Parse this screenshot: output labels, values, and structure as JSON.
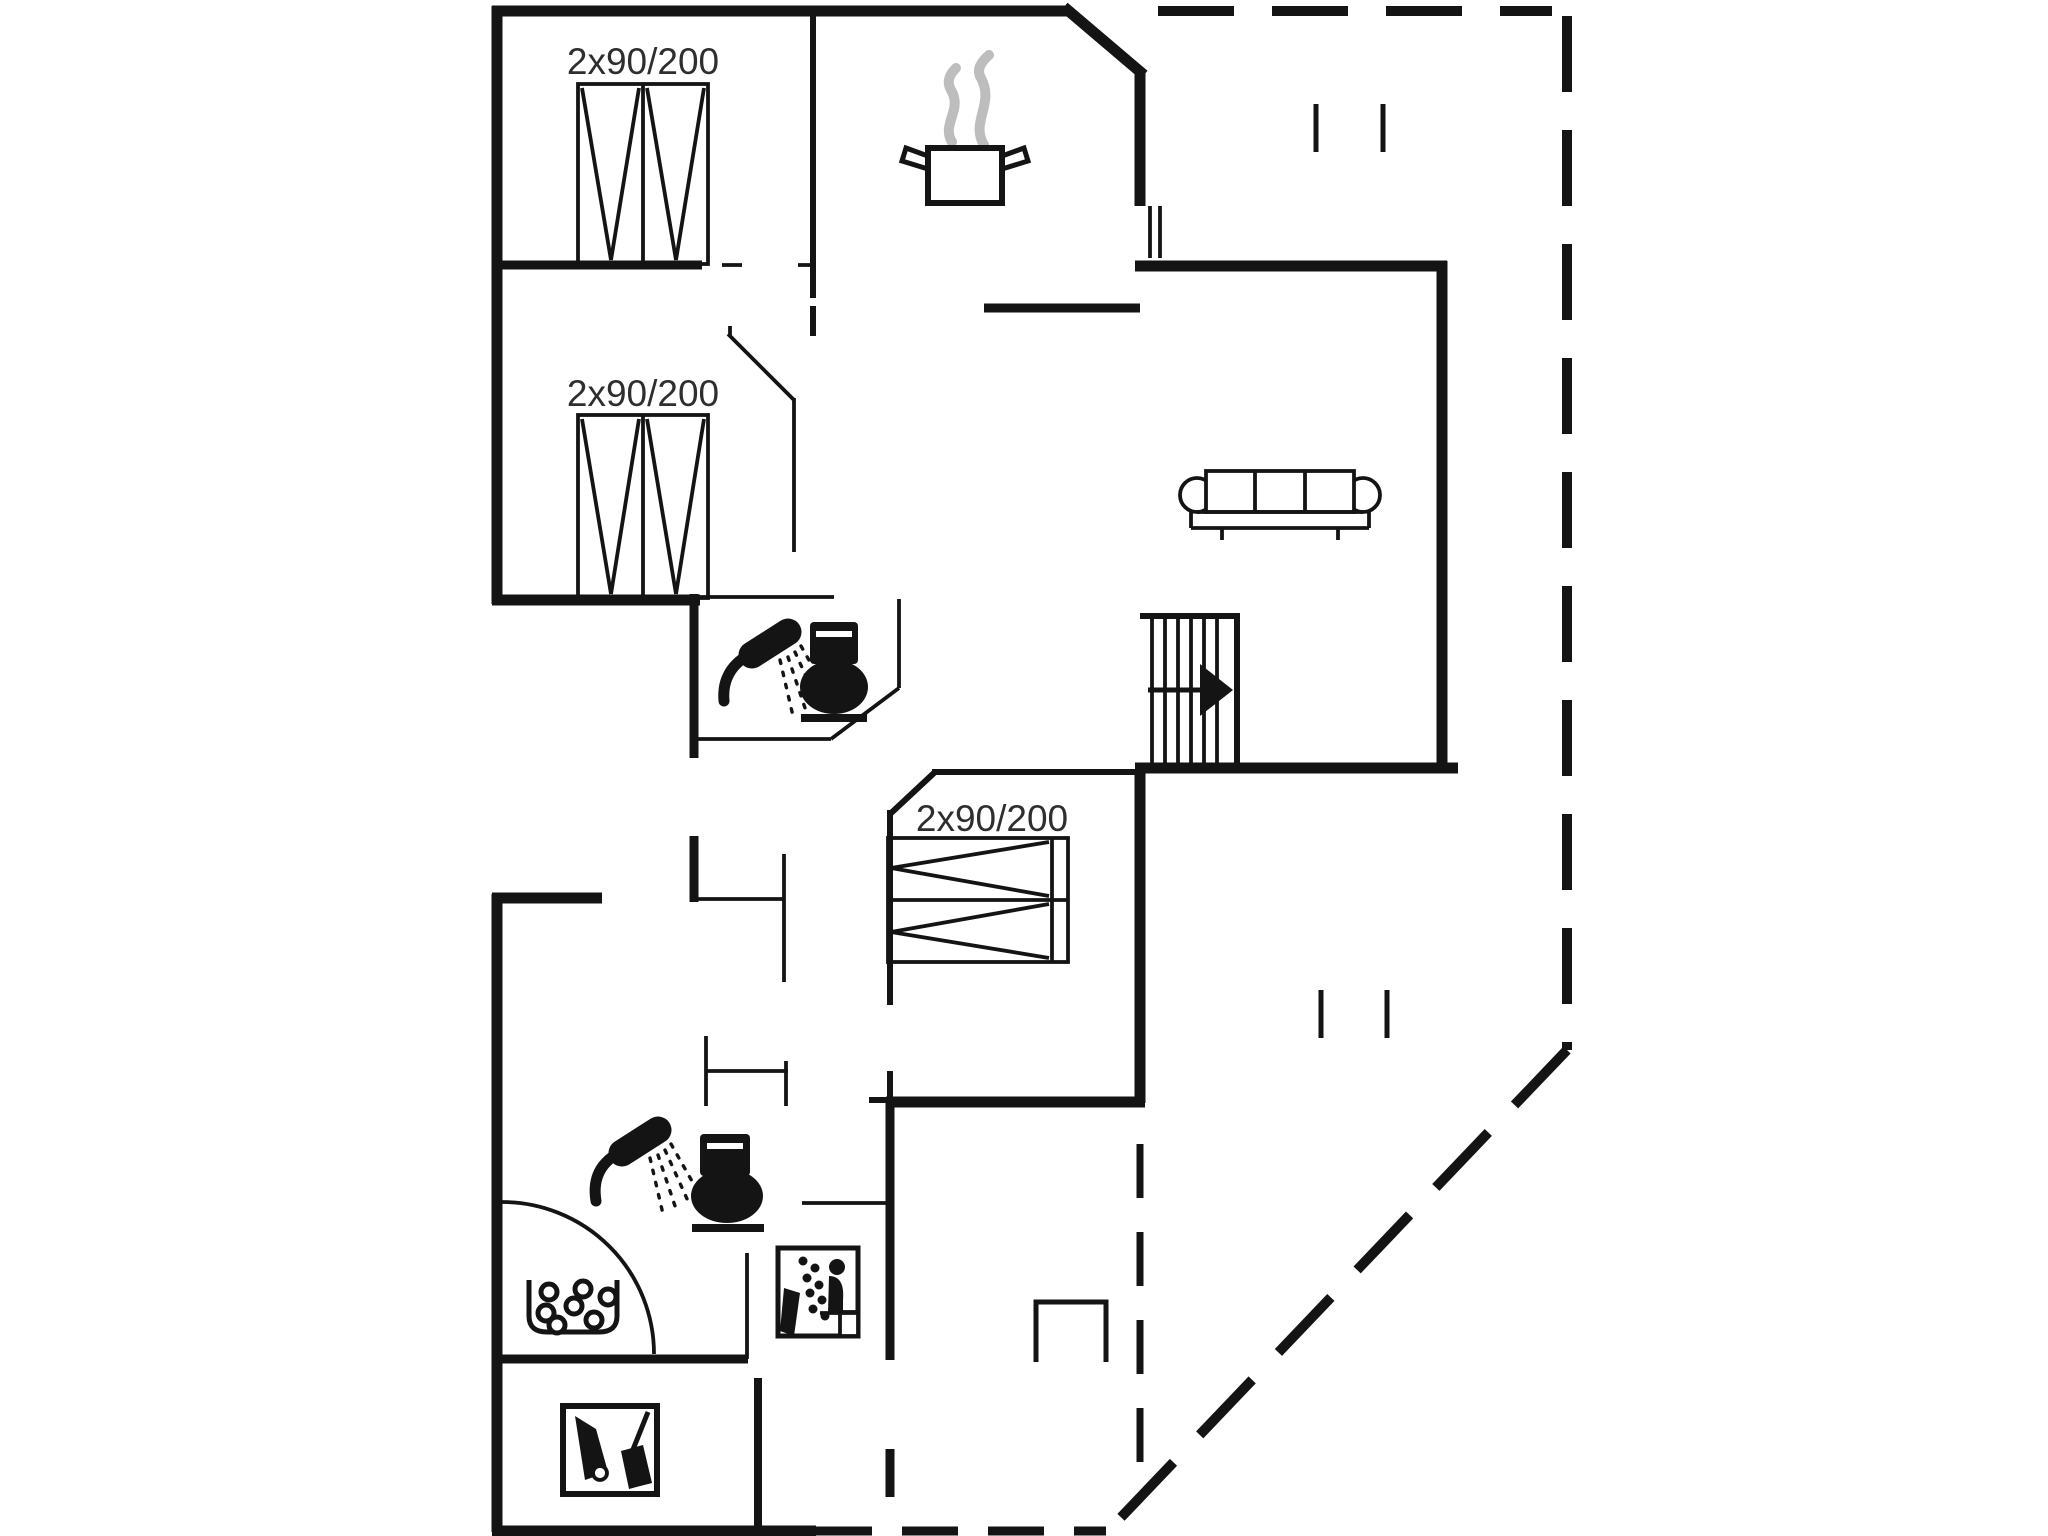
{
  "document": {
    "type": "floor-plan",
    "bed_dimension_labels": [
      {
        "id": "bed1",
        "label": "2x90/200"
      },
      {
        "id": "bed2",
        "label": "2x90/200"
      },
      {
        "id": "bed3",
        "label": "2x90/200"
      }
    ],
    "symbols": [
      {
        "name": "double-bed-icon",
        "meaning": "double bed 2x90/200"
      },
      {
        "name": "double-bed-icon",
        "meaning": "double bed 2x90/200"
      },
      {
        "name": "double-bed-icon",
        "meaning": "double bed 2x90/200"
      },
      {
        "name": "cooking-pot-icon",
        "meaning": "kitchen"
      },
      {
        "name": "sofa-icon",
        "meaning": "living room"
      },
      {
        "name": "staircase-icon",
        "meaning": "stairs with up direction arrow"
      },
      {
        "name": "shower-icon",
        "meaning": "bathroom shower"
      },
      {
        "name": "toilet-icon",
        "meaning": "bathroom toilet"
      },
      {
        "name": "shower-icon",
        "meaning": "bathroom 2 shower"
      },
      {
        "name": "toilet-icon",
        "meaning": "bathroom 2 toilet"
      },
      {
        "name": "whirlpool-icon",
        "meaning": "whirlpool / bubble bath"
      },
      {
        "name": "sauna-icon",
        "meaning": "sauna"
      },
      {
        "name": "cleaning-equipment-icon",
        "meaning": "utility / cleaning room"
      },
      {
        "name": "dashed-line",
        "meaning": "terrace / roofed outdoor boundary"
      }
    ]
  },
  "labels": {
    "bed1": "2x90/200",
    "bed2": "2x90/200",
    "bed3": "2x90/200"
  },
  "colors": {
    "background": "#ffffff",
    "wall": "#141414",
    "label": "#2e2e2e",
    "steam": "#bdbdbd"
  }
}
